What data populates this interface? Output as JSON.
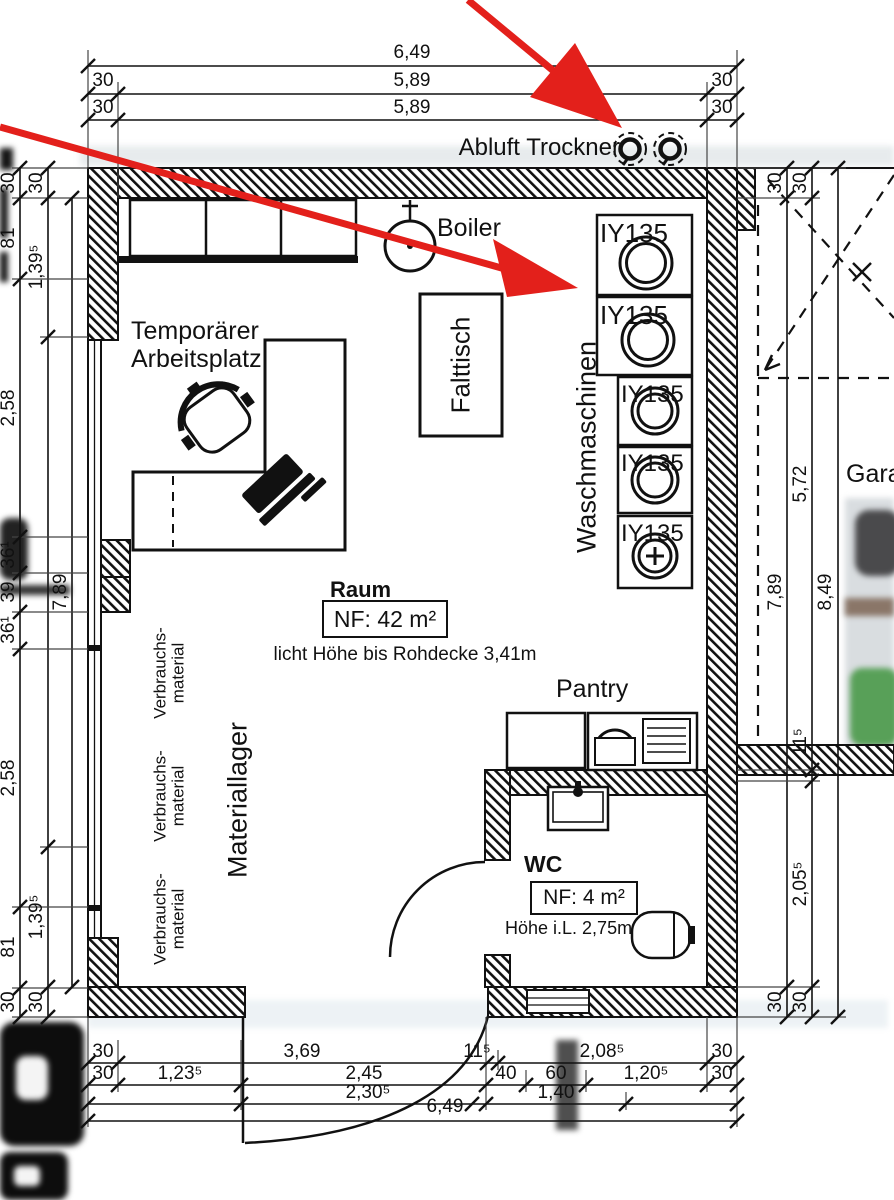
{
  "colors": {
    "arrow_red": "#e3201b",
    "ink": "#111111"
  },
  "top": {
    "vent_label": "Abluft Trockner",
    "dims": {
      "total": "6,49",
      "row2": [
        "30",
        "5,89",
        "30"
      ],
      "row3": [
        "30",
        "5,89",
        "30"
      ]
    }
  },
  "room": {
    "name": "Raum",
    "area": "NF: 42 m²",
    "height_note": "licht Höhe bis Rohdecke 3,41m",
    "boiler_label": "Boiler",
    "folding_table_label": "Falttisch",
    "workspace_lines": [
      "Temporärer",
      "Arbeitsplatz"
    ],
    "washers_label": "Waschmaschinen",
    "machines": [
      {
        "tag": "IY135"
      },
      {
        "tag": "IY135"
      },
      {
        "tag": "IY135"
      },
      {
        "tag": "IY135"
      },
      {
        "tag": "IY135"
      }
    ],
    "storage_label": "Materiallager",
    "shelves": [
      {
        "lines": [
          "Verbrauchs-",
          "material"
        ]
      },
      {
        "lines": [
          "Verbrauchs-",
          "material"
        ]
      },
      {
        "lines": [
          "Verbrauchs-",
          "material"
        ]
      }
    ]
  },
  "pantry": {
    "label": "Pantry"
  },
  "wc": {
    "name": "WC",
    "area": "NF: 4 m²",
    "height_note": "Höhe i.L. 2,75m"
  },
  "garage": {
    "label": "Garage"
  },
  "dims_bottom": {
    "row1": [
      "30",
      "3,69",
      "11⁵",
      "2,08⁵",
      "30"
    ],
    "row2": [
      "30",
      "1,23⁵",
      "2,45",
      "40",
      "60",
      "1,20⁵",
      "30"
    ],
    "row3": [
      "2,30⁵",
      "1,40"
    ],
    "total": "6,49"
  },
  "dims_left": {
    "outer": [
      "30",
      "81",
      "2,58",
      "36¹",
      "39",
      "36¹",
      "2,58",
      "81",
      "30"
    ],
    "inner": [
      "30",
      "1,39⁵",
      "1,39⁵",
      "30"
    ],
    "total": "7,89"
  },
  "dims_right": {
    "chain1": [
      "30",
      "7,89",
      "30"
    ],
    "chain2": [
      "30",
      "5,72",
      "11⁵",
      "2,05⁵",
      "30"
    ],
    "total": "8,49"
  }
}
